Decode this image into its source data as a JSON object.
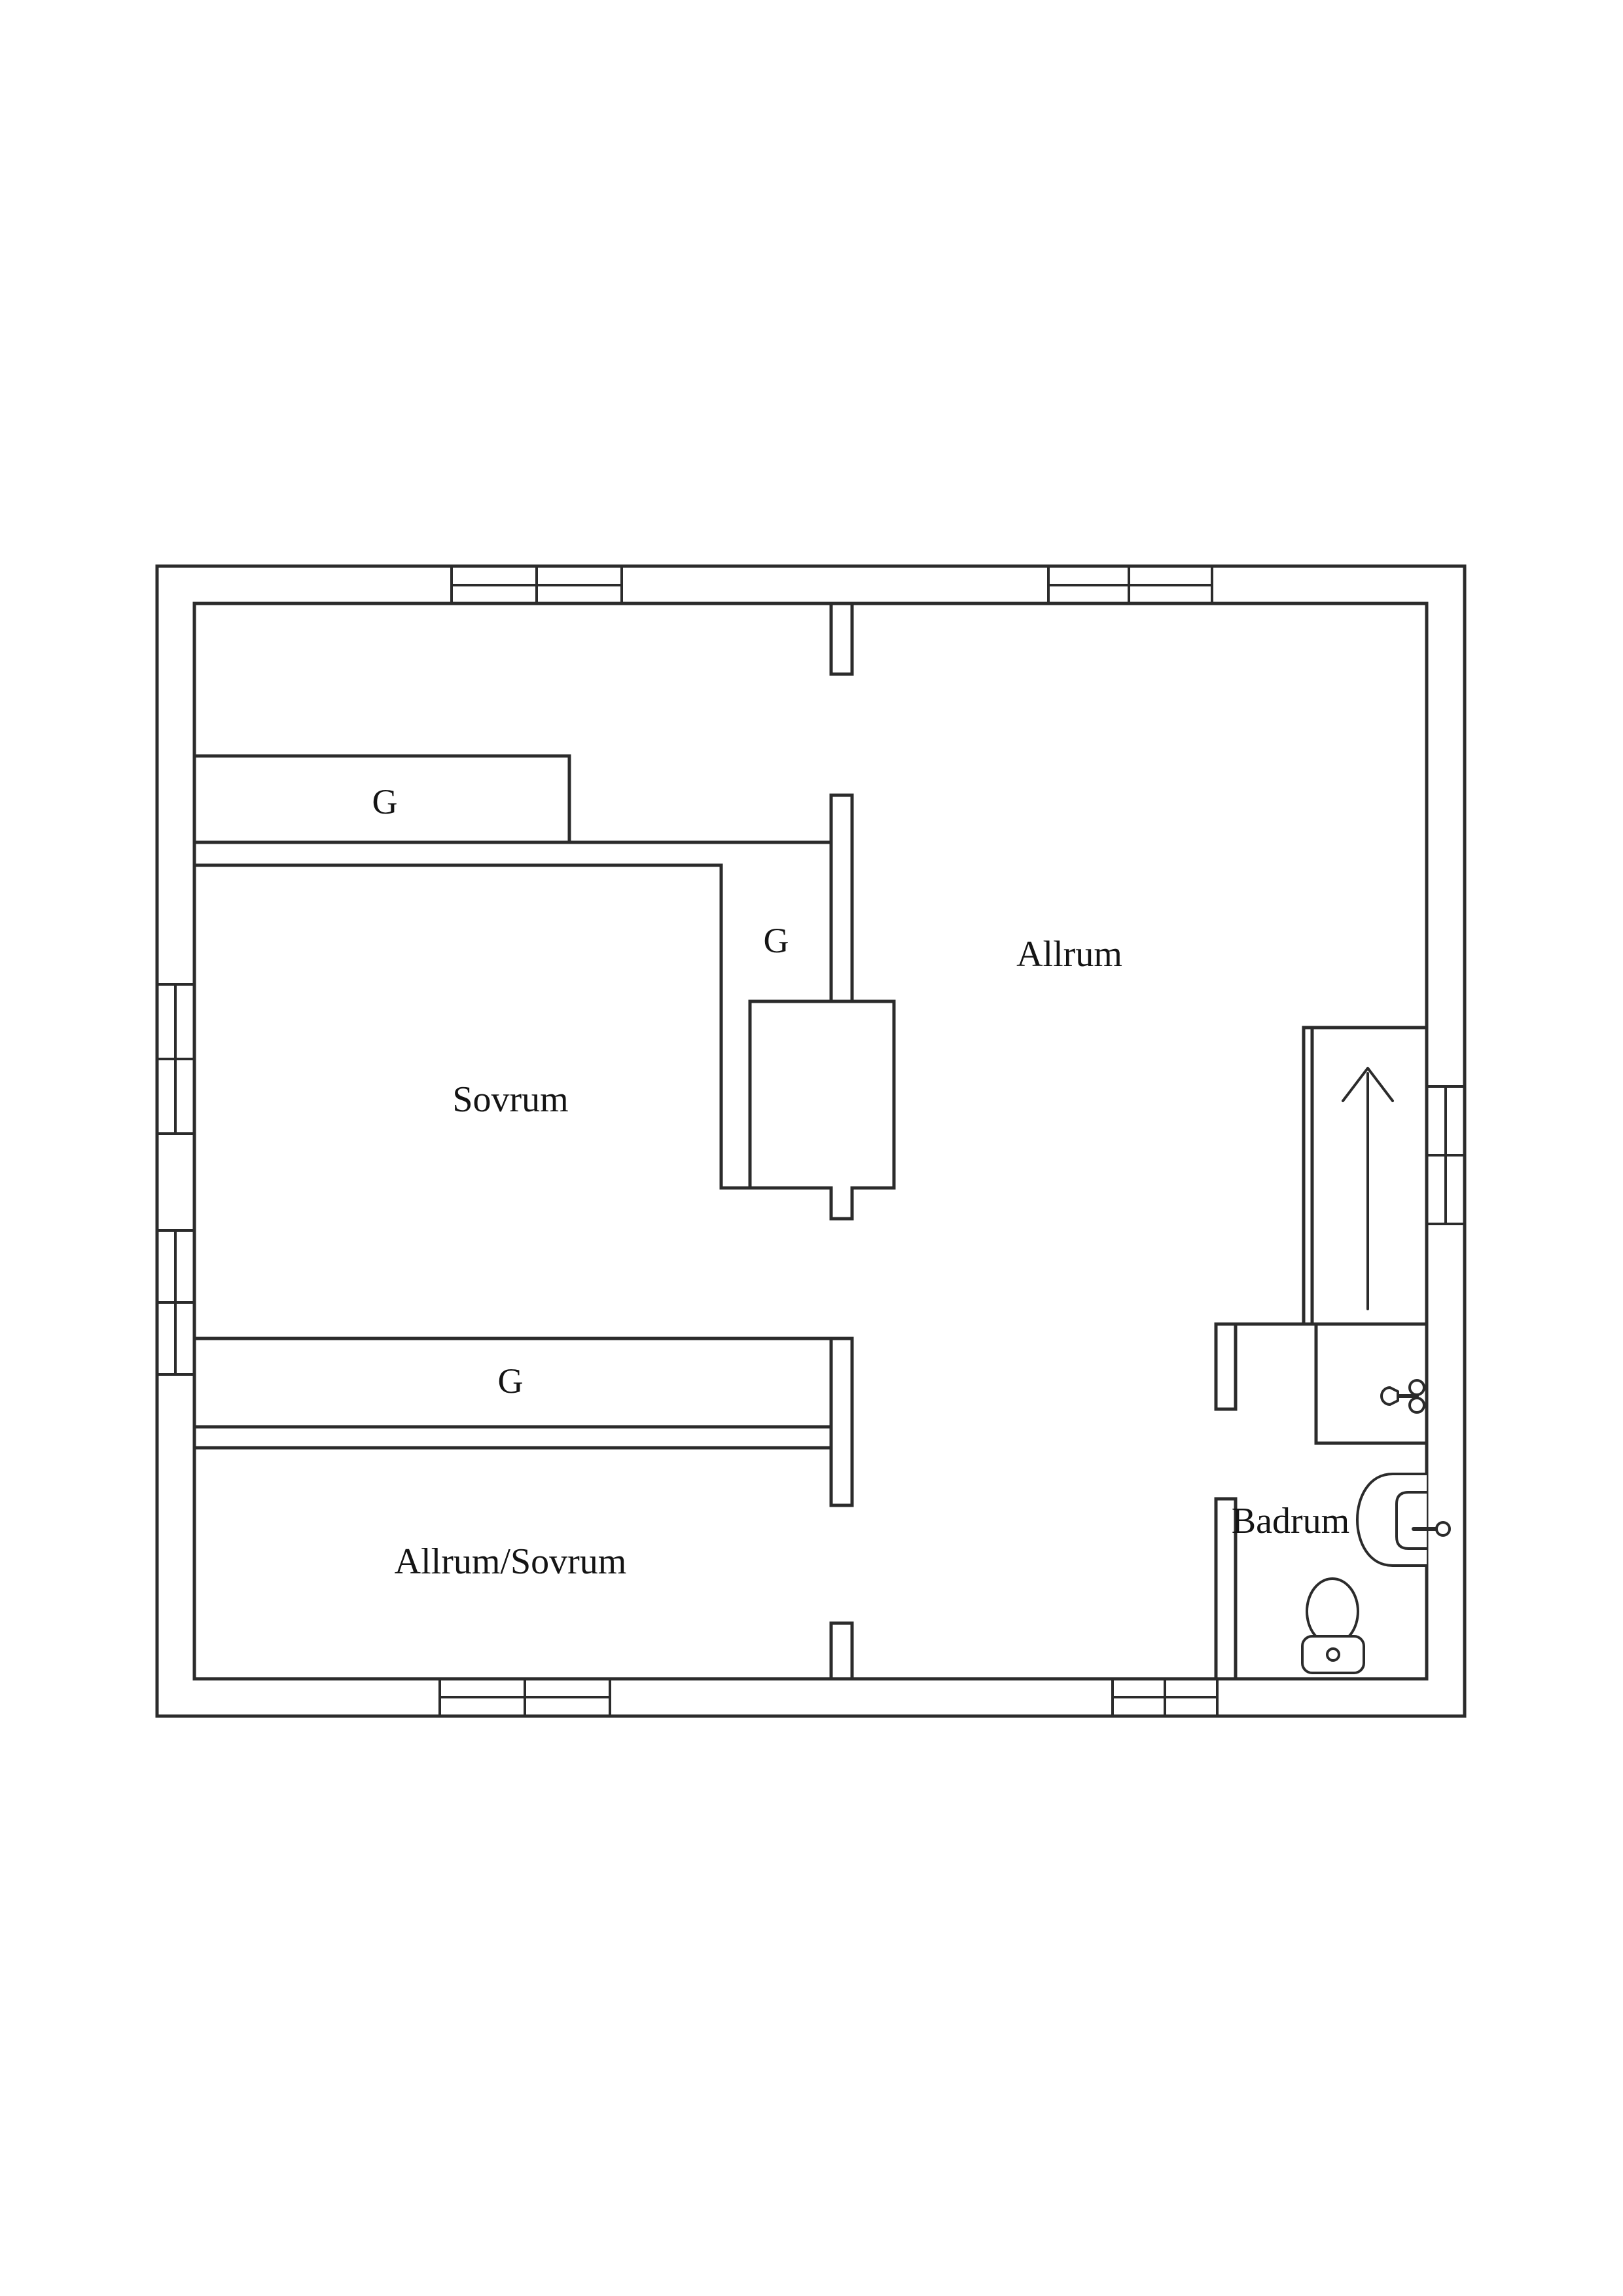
{
  "floor_plan": {
    "colors": {
      "background": "#ffffff",
      "wall_line": "#2b2b2b",
      "text": "#141414"
    },
    "rooms": [
      {
        "id": "sovrum",
        "label": "Sovrum"
      },
      {
        "id": "allrum",
        "label": "Allrum"
      },
      {
        "id": "allrum-sovrum",
        "label": "Allrum/Sovrum"
      },
      {
        "id": "badrum",
        "label": "Badrum"
      }
    ],
    "closets": [
      {
        "id": "closet-top-left",
        "label": "G"
      },
      {
        "id": "closet-middle",
        "label": "G"
      },
      {
        "id": "closet-long",
        "label": "G"
      }
    ],
    "icons": [
      {
        "name": "stairs-up-arrow-icon"
      },
      {
        "name": "toilet-icon"
      },
      {
        "name": "sink-icon"
      },
      {
        "name": "tap-icon"
      }
    ]
  }
}
